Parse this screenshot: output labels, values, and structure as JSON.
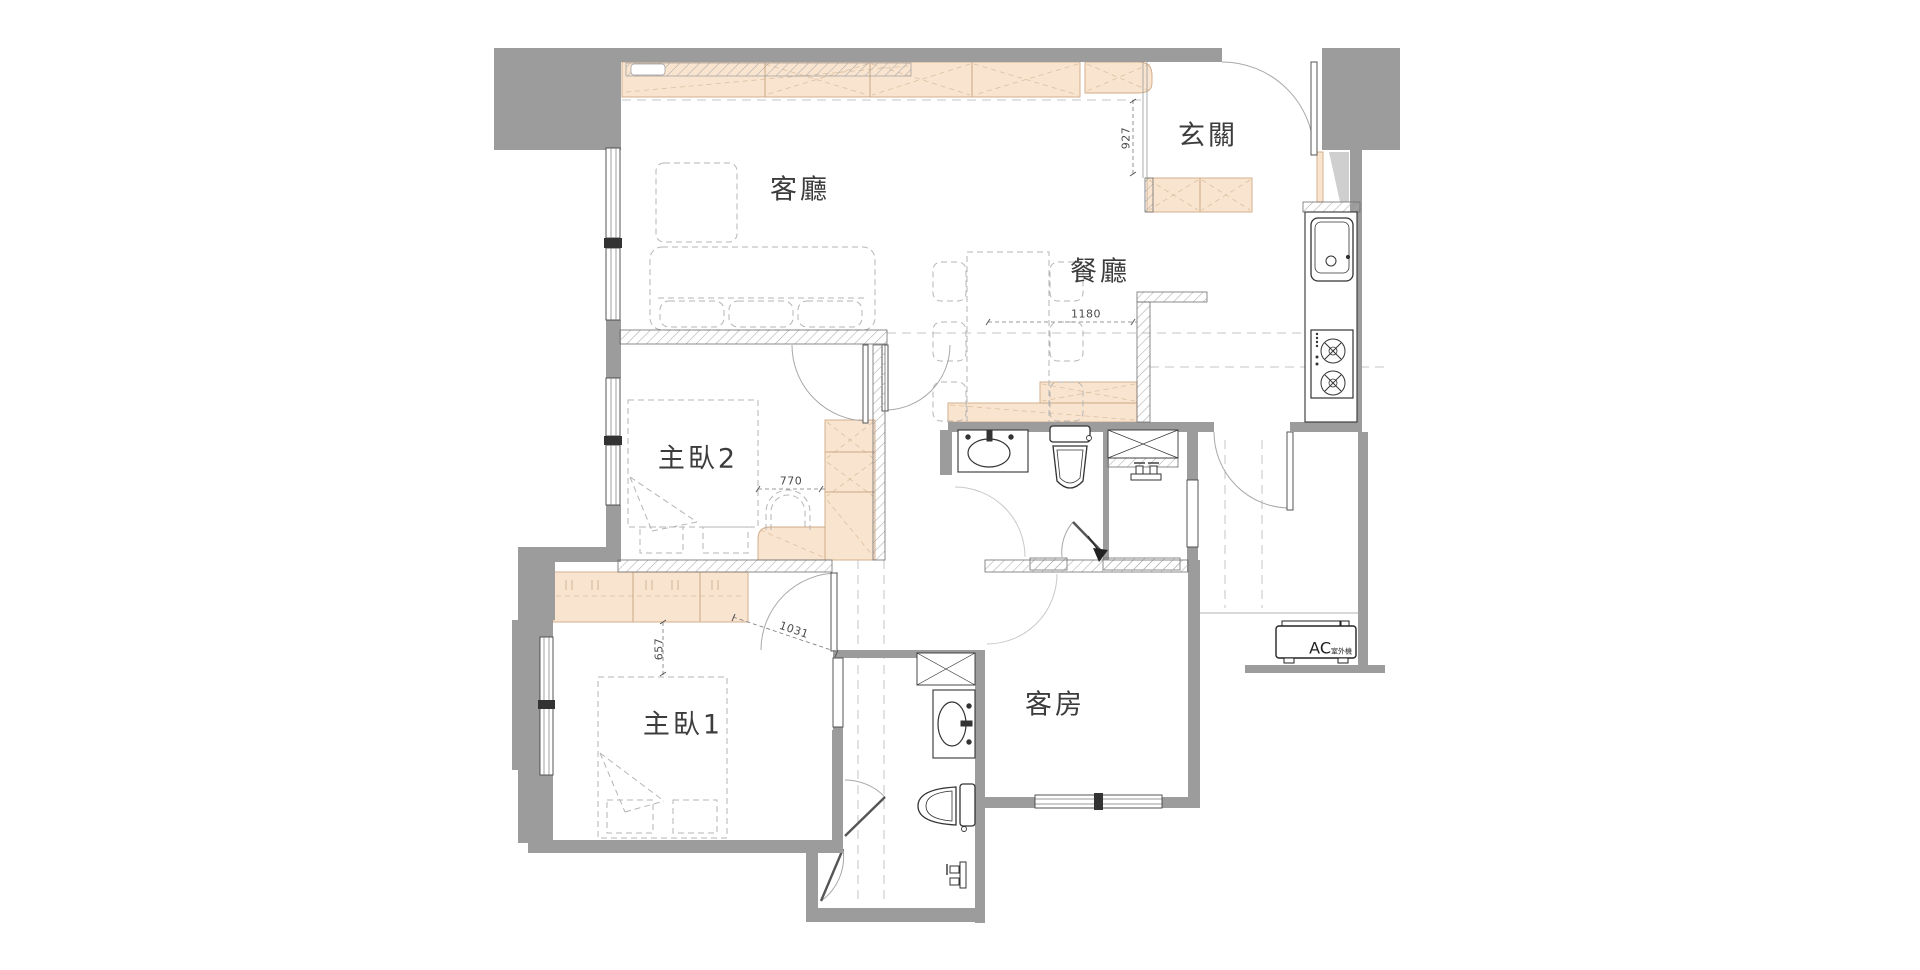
{
  "plan_title": "apartment floor plan",
  "rooms": {
    "living": {
      "label": "客廳"
    },
    "dining": {
      "label": "餐廳"
    },
    "foyer": {
      "label": "玄關"
    },
    "master2": {
      "label": "主臥2"
    },
    "master1": {
      "label": "主臥1"
    },
    "guest": {
      "label": "客房"
    }
  },
  "dimensions": {
    "foyer_depth": "927",
    "dining_width": "1180",
    "master2_clearance": "770",
    "master1_clearance": "657",
    "hall_diagonal": "1031"
  },
  "equipment": {
    "ac_label": "AC",
    "ac_sub": "室外機"
  },
  "icons": [
    "sink-icon",
    "stove-icon",
    "toilet-icon",
    "washer-icon",
    "basin-icon",
    "faucet-icon",
    "ac-outdoor-unit-icon",
    "entry-arrow-icon"
  ],
  "colors": {
    "wall_gray": "#9c9c9c",
    "cabinet_peach": "#f9e4d0",
    "cabinet_border": "#d3b190",
    "fixture_line": "#333333",
    "furniture_dash": "#b5b5b5"
  }
}
